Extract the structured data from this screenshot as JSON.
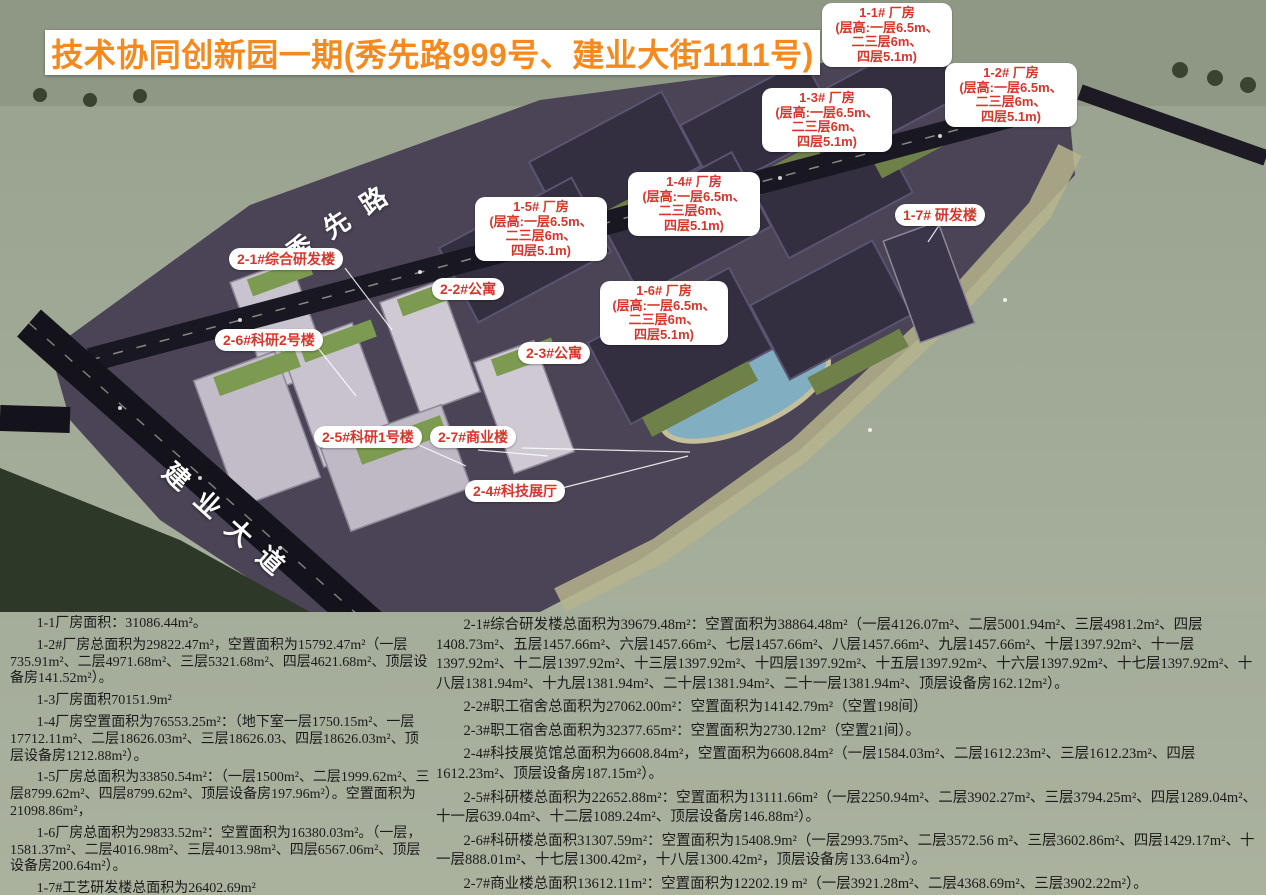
{
  "title": "技术协同创新园一期(秀先路999号、建业大街1111号)",
  "colors": {
    "title_orange": "#F5891D",
    "label_red": "#D8352B",
    "label_bg": "#FFFFFF",
    "water": "#9CA797",
    "land": "#4B4456",
    "road": "#191722"
  },
  "roads": {
    "xiuxian": "秀先路",
    "jianye": "建业大道"
  },
  "labels": {
    "f11": {
      "lines": [
        "1-1# 厂房",
        "(层高:一层6.5m、",
        "二三层6m、",
        "四层5.1m)"
      ]
    },
    "f12": {
      "lines": [
        "1-2# 厂房",
        "(层高:一层6.5m、",
        "二三层6m、",
        "四层5.1m)"
      ]
    },
    "f13": {
      "lines": [
        "1-3# 厂房",
        "(层高:一层6.5m、",
        "二三层6m、",
        "四层5.1m)"
      ]
    },
    "f14": {
      "lines": [
        "1-4# 厂房",
        "(层高:一层6.5m、",
        "二三层6m、",
        "四层5.1m)"
      ]
    },
    "f15": {
      "lines": [
        "1-5# 厂房",
        "(层高:一层6.5m、",
        "二三层6m、",
        "四层5.1m)"
      ]
    },
    "f16": {
      "lines": [
        "1-6# 厂房",
        "(层高:一层6.5m、",
        "二三层6m、",
        "四层5.1m)"
      ]
    },
    "f17": {
      "text": "1-7# 研发楼"
    },
    "c21": {
      "text": "2-1#综合研发楼"
    },
    "c22": {
      "text": "2-2#公寓"
    },
    "c23": {
      "text": "2-3#公寓"
    },
    "c24": {
      "text": "2-4#科技展厅"
    },
    "c25": {
      "text": "2-5#科研1号楼"
    },
    "c26": {
      "text": "2-6#科研2号楼"
    },
    "c27": {
      "text": "2-7#商业楼"
    }
  },
  "notes_left": [
    "1-1厂房面积：31086.44m²。",
    "1-2#厂房总面积为29822.47m²，空置面积为15792.47m²（一层735.91m²、二层4971.68m²、三层5321.68m²、四层4621.68m²、顶层设备房141.52m²）。",
    "1-3厂房面积70151.9m²",
    "1-4厂房空置面积为76553.25m²：（地下室一层1750.15m²、一层17712.11m²、二层18626.03m²、三层18626.03、四层18626.03m²、顶层设备房1212.88m²）。",
    "1-5厂房总面积为33850.54m²：（一层1500m²、二层1999.62m²、三层8799.62m²、四层8799.62m²、顶层设备房197.96m²）。空置面积为21098.86m²，",
    "1-6厂房总面积为29833.52m²：空置面积为16380.03m²。（一层，1581.37m²、二层4016.98m²、三层4013.98m²、四层6567.06m²、顶层设备房200.64m²）。",
    "1-7#工艺研发楼总面积为26402.69m²"
  ],
  "notes_right": [
    "2-1#综合研发楼总面积为39679.48m²：空置面积为38864.48m²（一层4126.07m²、二层5001.94m²、三层4981.2m²、四层1408.73m²、五层1457.66m²、六层1457.66m²、七层1457.66m²、八层1457.66m²、九层1457.66m²、十层1397.92m²、十一层1397.92m²、十二层1397.92m²、十三层1397.92m²、十四层1397.92m²、十五层1397.92m²、十六层1397.92m²、十七层1397.92m²、十八层1381.94m²、十九层1381.94m²、二十层1381.94m²、二十一层1381.94m²、顶层设备房162.12m²）。",
    "2-2#职工宿舍总面积为27062.00m²：空置面积为14142.79m²（空置198间）",
    "2-3#职工宿舍总面积为32377.65m²：空置面积为2730.12m²（空置21间）。",
    "2-4#科技展览馆总面积为6608.84m²，空置面积为6608.84m²（一层1584.03m²、二层1612.23m²、三层1612.23m²、四层1612.23m²、顶层设备房187.15m²）。",
    "2-5#科研楼总面积为22652.88m²：空置面积为13111.66m²（一层2250.94m²、二层3902.27m²、三层3794.25m²、四层1289.04m²、十一层639.04m²、十二层1089.24m²、顶层设备房146.88m²）。",
    "2-6#科研楼总面积31307.59m²：空置面积为15408.9m²（一层2993.75m²、二层3572.56 m²、三层3602.86m²、四层1429.17m²、十一层888.01m²、十七层1300.42m²，十八层1300.42m²，顶层设备房133.64m²）。",
    "2-7#商业楼总面积13612.11m²：空置面积为12202.19 m²（一层3921.28m²、二层4368.69m²、三层3902.22m²）。"
  ]
}
